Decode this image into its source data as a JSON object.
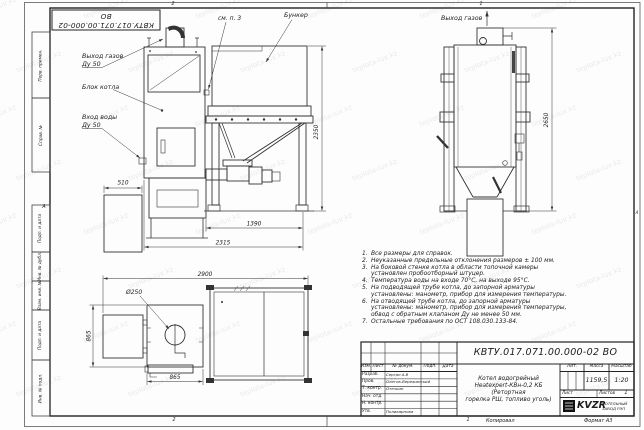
{
  "sheet": {
    "doc_number": "КВТУ.017.071.00.000-02 ВО",
    "copied_label": "Копировал",
    "format_label": "Формат А3",
    "zone_top_left": "2",
    "zone_top_right": "1",
    "zone_bottom_left": "2",
    "zone_bottom_right": "1",
    "zone_letter_left": "А",
    "zone_letter_right": "А"
  },
  "watermark": {
    "text": "teplota-lux.kz"
  },
  "margin_labels": {
    "items": [
      {
        "label": "Перв. примен."
      },
      {
        "label": "Справ. №"
      },
      {
        "label": "Подп. и дата"
      },
      {
        "label": "Инв. № дубл."
      },
      {
        "label": "Взам. инв. №"
      },
      {
        "label": "Подп. и дата"
      },
      {
        "label": "Инв. № подл."
      }
    ]
  },
  "drawing": {
    "front_view": {
      "gas_out_label": "Выход газов",
      "gas_out_du": "Ду 50",
      "boiler_block_label": "Блок котла",
      "water_in_label": "Вход воды",
      "water_in_du": "Ду 50",
      "see_note_label": "см. п. 3",
      "bunker_label": "Бункер",
      "dim_width_aux": "510",
      "dim_height": "2350",
      "dim_width_bunker": "1390",
      "dim_width_total": "2315"
    },
    "side_view": {
      "gas_out_label": "Выход газов",
      "dim_height": "2650"
    },
    "plan_view": {
      "dim_width_total": "2900",
      "dim_diameter": "Ø250",
      "dim_depth": "865",
      "dim_width_burner": "865"
    }
  },
  "notes": {
    "items": [
      {
        "num": "1.",
        "text": "Все размеры для справок."
      },
      {
        "num": "2.",
        "text": "Неуказанные предельные отклонения размеров ± 100 мм."
      },
      {
        "num": "3.",
        "text": "На боковой стенке котла в области топочной камеры установлен пробоотборный штуцер."
      },
      {
        "num": "4.",
        "text": "Температура воды на входе 70°С, на выходе 95°С."
      },
      {
        "num": "5.",
        "text": "На подводящей трубе котла, до запорной арматуры установлены: манометр, прибор для измерения температуры."
      },
      {
        "num": "6.",
        "text": "На отводящей трубе котла, до запорной арматуры установлены: манометр, прибор для измерения температуры, обвод с обратным клапаном Ду не менее 50 мм."
      },
      {
        "num": "7.",
        "text": "Остальные требования по ОСТ 108.030.133-84."
      }
    ]
  },
  "title_block": {
    "doc_number": "КВТУ.017.071.00.000-02 ВО",
    "product_line1": "Котел водогрейный",
    "product_line2": "Heatexpert-КВн-0,2 КБ (Ретортная",
    "product_line3": "горелка РШ, топливо уголь)",
    "col_izm": "Изм.",
    "col_list": "Лист",
    "col_doc": "№ докум.",
    "col_podp": "Подп.",
    "col_data": "Дата",
    "rows": [
      {
        "role": "Разраб.",
        "name": "Серган А.В"
      },
      {
        "role": "Пров.",
        "name": "Олегов-Вережинский"
      },
      {
        "role": "Т. контр.",
        "name": "Отечкин"
      },
      {
        "role": "Нач. отд.",
        "name": ""
      },
      {
        "role": "Н. контр.",
        "name": ""
      },
      {
        "role": "Утв.",
        "name": "Поликарпова"
      }
    ],
    "lit_label": "Лит.",
    "mass_label": "Масса",
    "scale_label": "Масштаб",
    "mass_value": "1159,5",
    "scale_value": "1:20",
    "sheet_label": "Лист",
    "sheets_label": "Листов",
    "sheets_value": "1",
    "logo_text": "KVZR",
    "company_line1": "КОТЕЛЬНЫЙ",
    "company_line2": "ЗАВОД РЭП"
  }
}
